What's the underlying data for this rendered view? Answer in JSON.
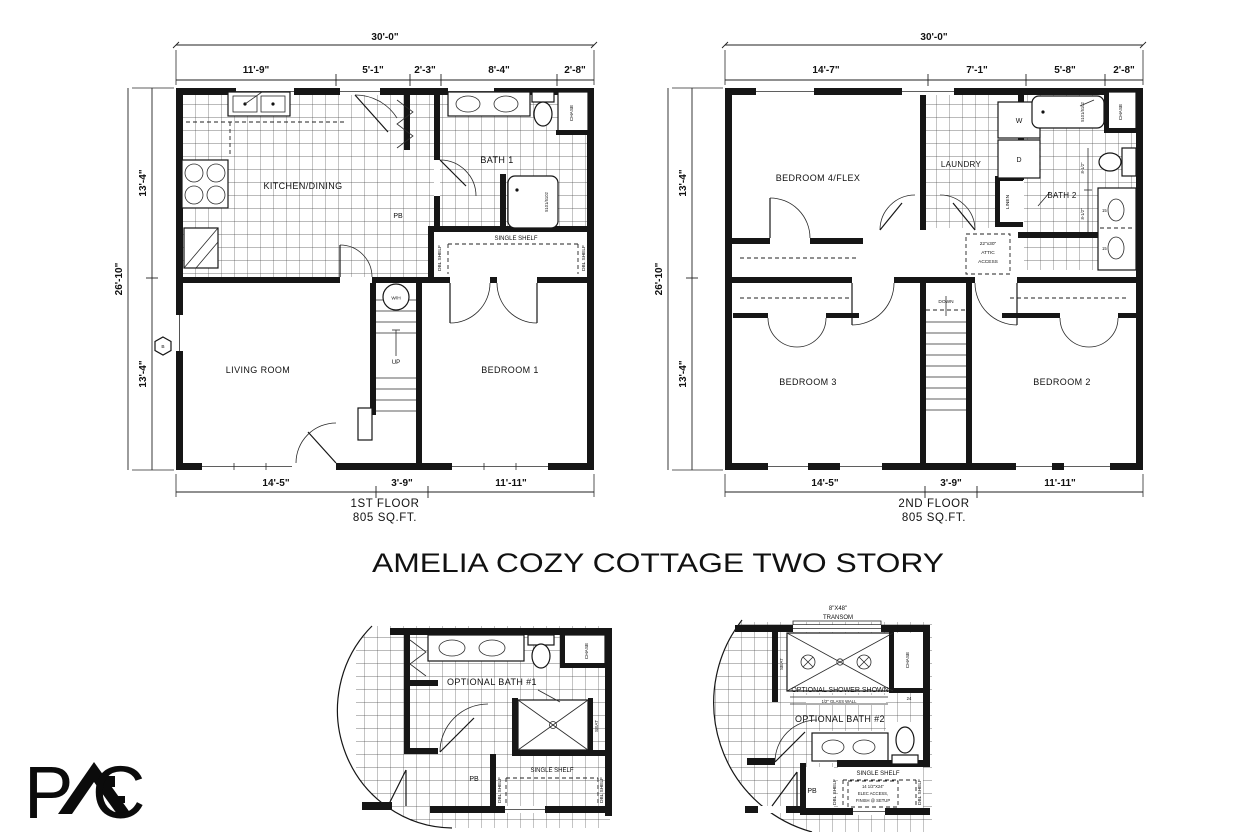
{
  "title": "AMELIA COZY COTTAGE TWO STORY",
  "logo": {
    "p": "P",
    "c": "C"
  },
  "plan1": {
    "caption_line1": "1ST FLOOR",
    "caption_line2": "805 SQ.FT.",
    "dims": {
      "width": "30'-0\"",
      "top": [
        "11'-9\"",
        "5'-1\"",
        "2'-3\"",
        "8'-4\"",
        "2'-8\""
      ],
      "height": "26'-10\"",
      "left": [
        "13'-4\"",
        "13'-4\""
      ],
      "bottom": [
        "14'-5\"",
        "3'-9\"",
        "11'-11\""
      ]
    },
    "rooms": {
      "kitchen": "KITCHEN/DINING",
      "bath": "BATH 1",
      "living": "LIVING ROOM",
      "bedroom": "BEDROOM 1"
    },
    "labels": {
      "chase": "CHASE",
      "pb": "PB",
      "single_shelf": "SINGLE SHELF",
      "dbl_shelf": "DBL SHELF",
      "wh": "W/H",
      "up": "UP",
      "b_marker": "B",
      "tub": "5101/5102"
    }
  },
  "plan2": {
    "caption_line1": "2ND FLOOR",
    "caption_line2": "805 SQ.FT.",
    "dims": {
      "width": "30'-0\"",
      "top": [
        "14'-7\"",
        "7'-1\"",
        "5'-8\"",
        "2'-8\""
      ],
      "height": "26'-10\"",
      "left": [
        "13'-4\"",
        "13'-4\""
      ],
      "bottom": [
        "14'-5\"",
        "3'-9\"",
        "11'-11\""
      ]
    },
    "rooms": {
      "bedroom4": "BEDROOM 4/FLEX",
      "laundry": "LAUNDRY",
      "bath": "BATH 2",
      "bedroom3": "BEDROOM 3",
      "bedroom2": "BEDROOM 2"
    },
    "labels": {
      "washer": "W",
      "dryer": "D",
      "linen": "LINEN",
      "chase": "CHASE",
      "down": "DOWN",
      "attic_line1": "22\"x30\"",
      "attic_line2": "ATTIC",
      "attic_line3": "ACCESS",
      "tub": "5101/5102",
      "sink_size": "15",
      "small_dim": "8-1/2\""
    }
  },
  "bath1": {
    "name": "OPTIONAL BATH #1",
    "chase": "CHASE",
    "seat": "SEAT",
    "pb": "PB",
    "single_shelf": "SINGLE SHELF",
    "dbl_shelf": "DBL SHELF"
  },
  "bath2": {
    "transom_line1": "8\"X48\"",
    "transom_line2": "TRANSOM",
    "seat": "SEAT",
    "shower_note": "OPTIONAL SHOWER SHOWN",
    "glass_wall": "1/2\" GLASS WALL",
    "chase": "CHASE",
    "chase_dim": "24",
    "name": "OPTIONAL BATH #2",
    "pb": "PB",
    "single_shelf": "SINGLE SHELF",
    "dbl_shelf": "DBL SHELF",
    "elec_line1": "14 1/2\"X24\"",
    "elec_line2": "ELEC ACCESS,",
    "elec_line3": "FINISH @ SETUP"
  }
}
